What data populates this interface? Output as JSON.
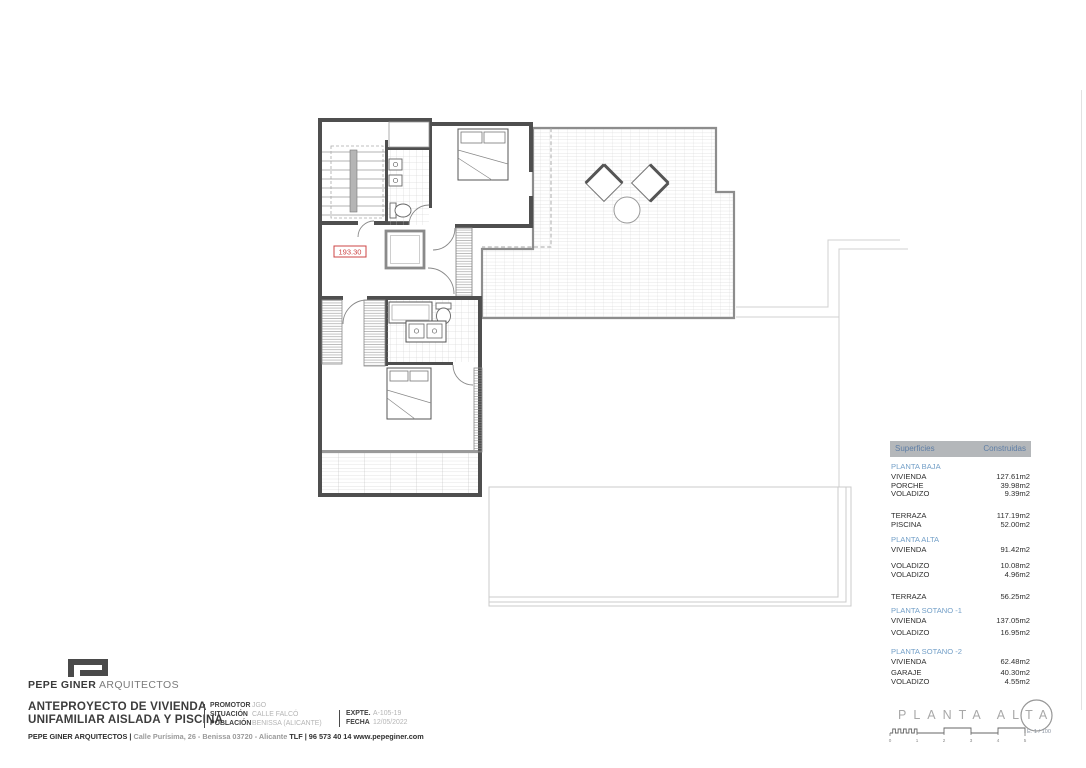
{
  "plan": {
    "elevation_label": "193.30"
  },
  "surfaces_table": {
    "header": {
      "col_label": "Superficies",
      "col_value": "Construidas"
    },
    "sections": [
      {
        "title": "PLANTA BAJA",
        "rows": [
          {
            "label": "VIVIENDA",
            "value": "127.61m2"
          },
          {
            "label": "PORCHE",
            "value": "39.98m2"
          },
          {
            "label": "VOLADIZO",
            "value": "9.39m2"
          },
          {
            "label": "TERRAZA",
            "value": "117.19m2"
          },
          {
            "label": "PISCINA",
            "value": "52.00m2"
          }
        ]
      },
      {
        "title": "PLANTA ALTA",
        "rows": [
          {
            "label": "VIVIENDA",
            "value": "91.42m2"
          },
          {
            "label": "VOLADIZO",
            "value": "10.08m2"
          },
          {
            "label": "VOLADIZO",
            "value": "4.96m2"
          },
          {
            "label": "TERRAZA",
            "value": "56.25m2"
          }
        ]
      },
      {
        "title": "PLANTA SOTANO -1",
        "rows": [
          {
            "label": "VIVIENDA",
            "value": "137.05m2"
          },
          {
            "label": "VOLADIZO",
            "value": "16.95m2"
          }
        ]
      },
      {
        "title": "PLANTA SOTANO -2",
        "rows": [
          {
            "label": "VIVIENDA",
            "value": "62.48m2"
          },
          {
            "label": "GARAJE",
            "value": "40.30m2"
          },
          {
            "label": "VOLADIZO",
            "value": "4.55m2"
          }
        ]
      }
    ]
  },
  "logo": {
    "name_bold": "PEPE GINER",
    "name_light": "ARQUITECTOS"
  },
  "title_block": {
    "project_line1": "ANTEPROYECTO DE VIVIENDA",
    "project_line2": "UNIFAMILIAR AISLADA Y PISCINA",
    "fields": [
      {
        "label": "PROMOTOR",
        "value": "JGO"
      },
      {
        "label": "SITUACIÓN",
        "value": "CALLE FALCÓ"
      },
      {
        "label": "POBLACIÓN",
        "value": "BENISSA (ALICANTE)"
      }
    ],
    "fields2": [
      {
        "label": "EXPTE.",
        "value": "A-105-19"
      },
      {
        "label": "FECHA",
        "value": "12/05/2022"
      }
    ],
    "footer": {
      "firm": "PEPE GINER ARQUITECTOS |",
      "address": "Calle Purísima, 26 - Benissa 03720 - Alicante",
      "tlf": "TLF | 96 573 40 14",
      "web": "www.pepeginer.com"
    }
  },
  "plan_label": {
    "title": "PLANTA ALTA",
    "scale": "E: 1 / 100",
    "ticks": [
      "0",
      "1",
      "2",
      "3",
      "4",
      "5"
    ]
  }
}
